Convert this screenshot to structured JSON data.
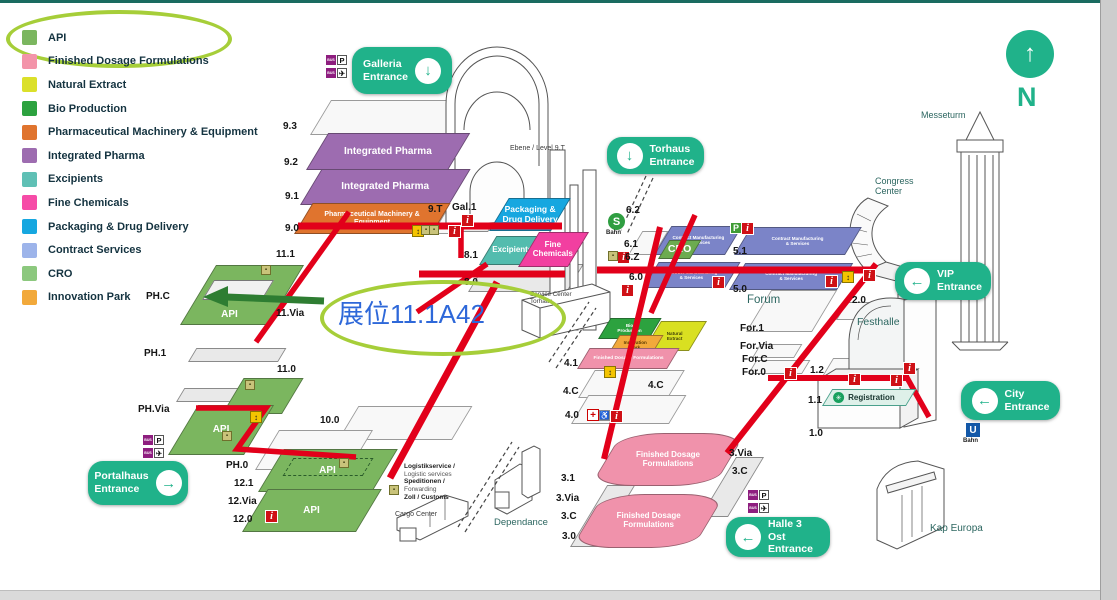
{
  "legend": {
    "items": [
      {
        "label": "API",
        "color": "#7bb65f"
      },
      {
        "label": "Finished Dosage Formulations",
        "color": "#f394a9"
      },
      {
        "label": "Natural Extract",
        "color": "#dbe02a"
      },
      {
        "label": "Bio Production",
        "color": "#2ca23f"
      },
      {
        "label": "Pharmaceutical Machinery & Equipment",
        "color": "#e0742e"
      },
      {
        "label": "Integrated Pharma",
        "color": "#9d6cb0"
      },
      {
        "label": "Excipients",
        "color": "#5fc0b5"
      },
      {
        "label": "Fine Chemicals",
        "color": "#f64ba7"
      },
      {
        "label": "Packaging & Drug Delivery",
        "color": "#16a7e0"
      },
      {
        "label": "Contract Services",
        "color": "#9db4ea"
      },
      {
        "label": "CRO",
        "color": "#8cc87e"
      },
      {
        "label": "Innovation Park",
        "color": "#f2a93b"
      }
    ],
    "highlight_color": "#a6ce39"
  },
  "annotation": {
    "booth_label": "展位11.1A42",
    "text_color": "#2e68d9",
    "highlight_color": "#a6ce39",
    "arrow_color": "#2e7d32"
  },
  "compass": {
    "north_label": "N"
  },
  "entrances": [
    {
      "id": "galleria",
      "label": "Galleria\nEntrance",
      "arrow": "down"
    },
    {
      "id": "torhaus",
      "label": "Torhaus\nEntrance",
      "arrow": "down"
    },
    {
      "id": "vip",
      "label": "VIP\nEntrance",
      "arrow": "left"
    },
    {
      "id": "city",
      "label": "City\nEntrance",
      "arrow": "left"
    },
    {
      "id": "halle-3-ost",
      "label": "Halle 3 Ost\nEntrance",
      "arrow": "left"
    },
    {
      "id": "portalhaus",
      "label": "Portalhaus\nEntrance",
      "arrow": "right"
    }
  ],
  "transit": {
    "s_bahn": {
      "symbol": "S",
      "label": "Bahn"
    },
    "u_bahn": {
      "symbol": "U",
      "label": "Bahn"
    }
  },
  "registration": {
    "label": "Registration"
  },
  "levels": [
    "9.3",
    "9.2",
    "9.1",
    "9.0",
    "9.T",
    "Gal.1",
    "8.1",
    "8.0",
    "11.1",
    "11.Via",
    "11.0",
    "10.0",
    "PH.C",
    "PH.1",
    "PH.Via",
    "PH.0",
    "12.1",
    "12.Via",
    "12.0",
    "6.2",
    "6.1",
    "6.Z",
    "6.0",
    "5.1",
    "5.0",
    "4.1",
    "4.C",
    "4.C",
    "4.0",
    "3.1",
    "3.Via",
    "3.C",
    "3.0",
    "3.Via",
    "3.C",
    "For.1",
    "For.Via",
    "For.C",
    "For.0",
    "2.0",
    "1.2",
    "1.1",
    "1.0"
  ],
  "slabs": [
    {
      "label": "Integrated Pharma",
      "color": "#9d6cb0",
      "text_color": "#ffffff"
    },
    {
      "label": "Integrated Pharma",
      "color": "#9d6cb0",
      "text_color": "#ffffff"
    },
    {
      "label": "Pharmaceutical Machinery & Equipment",
      "color": "#e0742e",
      "text_color": "#ffffff"
    },
    {
      "label": "Packaging & Drug Delivery",
      "color": "#16a7e0",
      "text_color": "#ffffff"
    },
    {
      "label": "Excipients",
      "color": "#53bcae",
      "text_color": "#ffffff"
    },
    {
      "label": "Fine Chemicals",
      "color": "#f23fa0",
      "text_color": "#ffffff"
    },
    {
      "label": "Contract Manufacturing\n& Services",
      "color": "#7b84c8",
      "text_color": "#ffffff"
    },
    {
      "label": "Contract Manufacturing\n& Services",
      "color": "#7b84c8",
      "text_color": "#ffffff"
    },
    {
      "label": "Contract Manufacturing\n& Services",
      "color": "#7b84c8",
      "text_color": "#ffffff"
    },
    {
      "label": "Contract Manufacturing\n& Services",
      "color": "#7b84c8",
      "text_color": "#ffffff"
    },
    {
      "label": "CRO",
      "color": "#6cab4f",
      "text_color": "#ffffff"
    },
    {
      "label": "API",
      "color": "#7bb65f",
      "text_color": "#ffffff"
    },
    {
      "label": "",
      "color": "#7bb65f",
      "text_color": "#ffffff"
    },
    {
      "label": "API",
      "color": "#7bb65f",
      "text_color": "#ffffff"
    },
    {
      "label": "API",
      "color": "#7bb65f",
      "text_color": "#ffffff"
    },
    {
      "label": "API",
      "color": "#7bb65f",
      "text_color": "#ffffff"
    },
    {
      "label": "Bio\nProduction",
      "color": "#2ca23f",
      "text_color": "#ffffff"
    },
    {
      "label": "Natural\nExtract",
      "color": "#d9e021",
      "text_color": "#43430a"
    },
    {
      "label": "Innovation\nPark",
      "color": "#f2a93b",
      "text_color": "#5a3a00"
    },
    {
      "label": "Finished Dosage Formulations",
      "color": "#f092ab",
      "text_color": "#ffffff"
    },
    {
      "label": "Finished Dosage\nFormulations",
      "color": "#f092ab",
      "text_color": "#ffffff"
    },
    {
      "label": "Finished Dosage\nFormulations",
      "color": "#f092ab",
      "text_color": "#ffffff"
    }
  ],
  "places": [
    {
      "label": "Messeturm"
    },
    {
      "label": "Congress\nCenter"
    },
    {
      "label": "Festhalle"
    },
    {
      "label": "Forum"
    },
    {
      "label": "Kap Europa"
    },
    {
      "label": "Dependance"
    },
    {
      "label": "Cargo Center"
    },
    {
      "label": "Service Center\nTorhaus"
    },
    {
      "label": "Ebene / Level 9.T"
    }
  ],
  "logistics_lines": [
    "Logistikservice /",
    "Logistic services",
    "Speditionen /",
    "Forwarding",
    "Zoll / Customs"
  ],
  "icon_glyphs": {
    "info": "i",
    "parking": "P",
    "bus": "BUS",
    "plane": "✈",
    "first_aid": "+",
    "escalator": "↕",
    "accessible": "♿"
  }
}
